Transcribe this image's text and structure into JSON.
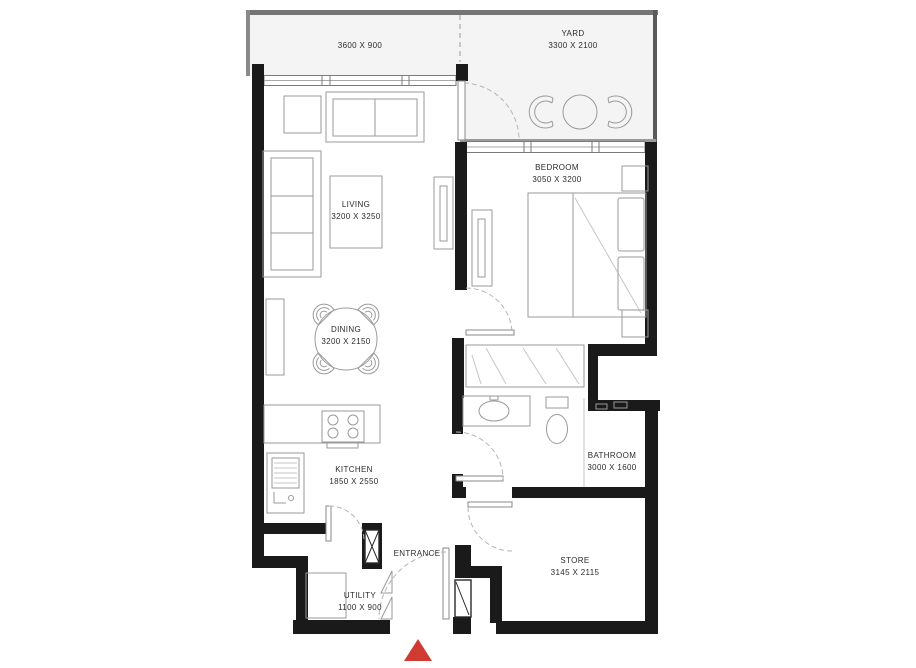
{
  "colors": {
    "wall_black": "#1a1a1a",
    "line_gray": "#9a9a9a",
    "line_light": "#c6c6c6",
    "floor_outdoor": "#f4f4f4",
    "marker_red": "#cf3a32",
    "text": "#2b2b2b"
  },
  "rooms": {
    "balcony": {
      "dims": "3600 X 900"
    },
    "yard": {
      "name": "YARD",
      "dims": "3300 X 2100"
    },
    "living": {
      "name": "LIVING",
      "dims": "3200 X 3250"
    },
    "bedroom": {
      "name": "BEDROOM",
      "dims": "3050 X 3200"
    },
    "dining": {
      "name": "DINING",
      "dims": "3200 X 2150"
    },
    "kitchen": {
      "name": "KITCHEN",
      "dims": "1850 X 2550"
    },
    "bathroom": {
      "name": "BATHROOM",
      "dims": "3000 X 1600"
    },
    "store": {
      "name": "STORE",
      "dims": "3145 X 2115"
    },
    "utility": {
      "name": "UTILITY",
      "dims": "1100 X 900"
    },
    "entrance": {
      "name": "ENTRANCE"
    }
  }
}
